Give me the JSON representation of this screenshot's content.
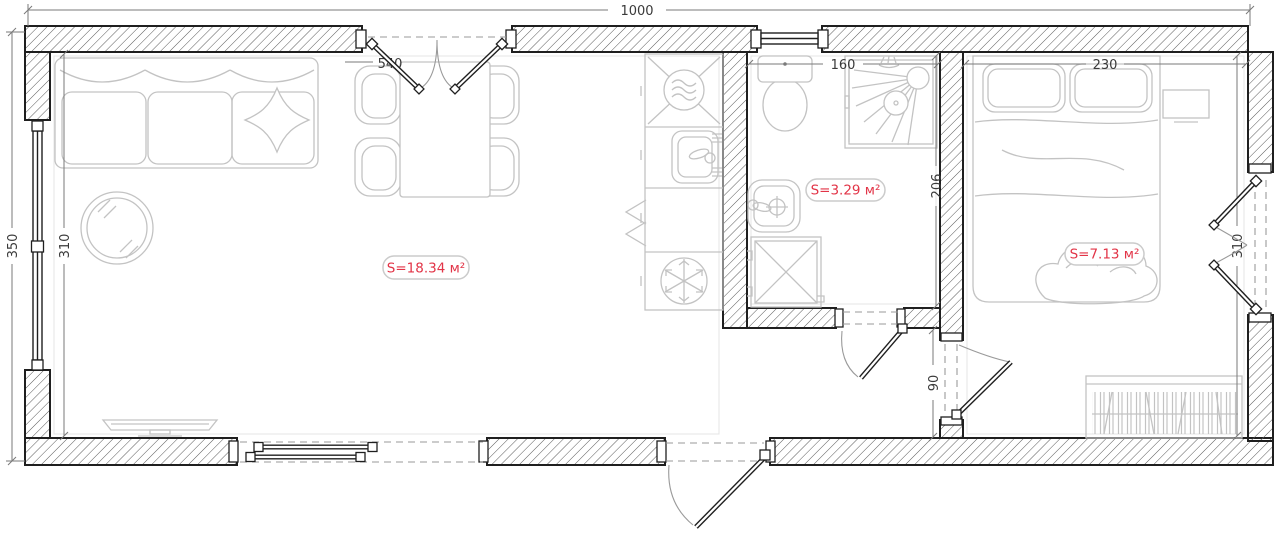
{
  "plan": {
    "type": "architectural floor plan",
    "labels": {
      "living_area": "S=18.34 м²",
      "bath_area": "S=3.29 м²",
      "bedroom_area": "S=7.13 м²"
    },
    "dims": {
      "total_width": "1000",
      "total_depth": "350",
      "living_opening": "540",
      "living_depth": "310",
      "bath_width": "160",
      "bath_depth": "206",
      "hall_width": "90",
      "bedroom_width": "230",
      "bedroom_depth": "310"
    },
    "colors": {
      "accent": "#e23447",
      "wall_line": "#1f1f1f",
      "furniture_line": "#c3c3c3",
      "dim_text": "#3a3a3a"
    },
    "icons": [
      "sofa",
      "pillow",
      "round-table",
      "tv",
      "dining-table",
      "chair",
      "washing-machine",
      "kitchen-sink",
      "folding-doors",
      "fridge-snowflake",
      "toilet",
      "shower-cabin",
      "wash-basin",
      "shower-tray",
      "bed",
      "nightstand",
      "bookshelf",
      "door-swing",
      "window"
    ]
  }
}
